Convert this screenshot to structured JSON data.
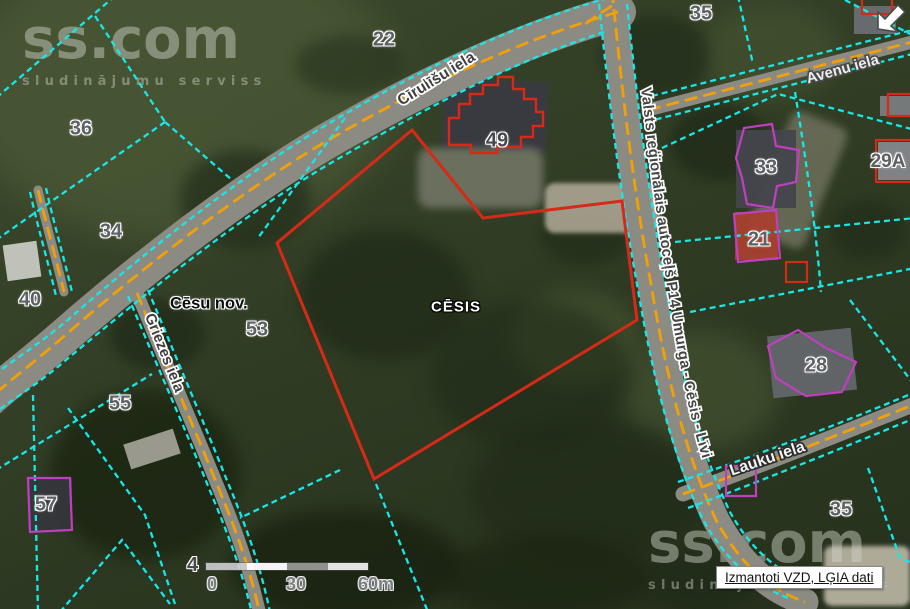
{
  "watermark": {
    "brand": "ss.com",
    "tagline": "sludinājumu serviss"
  },
  "icons": {
    "corner": "resize-diagonal-arrow-icon"
  },
  "map": {
    "municipality_label": "Cēsu nov.",
    "city_label": "CĒSIS",
    "streets": {
      "cirulisu": "Cīrulīšu iela",
      "avenu": "Avenu iela",
      "p14": "Valsts reģionālais autoceļš P14 Umurga - Cēsis - Līvi",
      "lauku": "Lauku iela",
      "griezes": "Griezes iela"
    },
    "parcels": [
      {
        "label": "22"
      },
      {
        "label": "36"
      },
      {
        "label": "34"
      },
      {
        "label": "40"
      },
      {
        "label": "49"
      },
      {
        "label": "35"
      },
      {
        "label": "33"
      },
      {
        "label": "29A"
      },
      {
        "label": "21"
      },
      {
        "label": "53"
      },
      {
        "label": "55"
      },
      {
        "label": "28"
      },
      {
        "label": "57"
      },
      {
        "label": "35"
      }
    ]
  },
  "scale_bar": {
    "left_tick": "4",
    "labels": [
      "0",
      "30",
      "60m"
    ]
  },
  "attribution": {
    "text": "Izmantoti VZD, LĢIA dati"
  },
  "colors": {
    "cadastral_line": "#17e7e7",
    "selected_parcel": "#d52a18",
    "building_outline": "#bf3fbf",
    "road_centerline": "#f2a007",
    "road_surface": "#8b8b83"
  }
}
